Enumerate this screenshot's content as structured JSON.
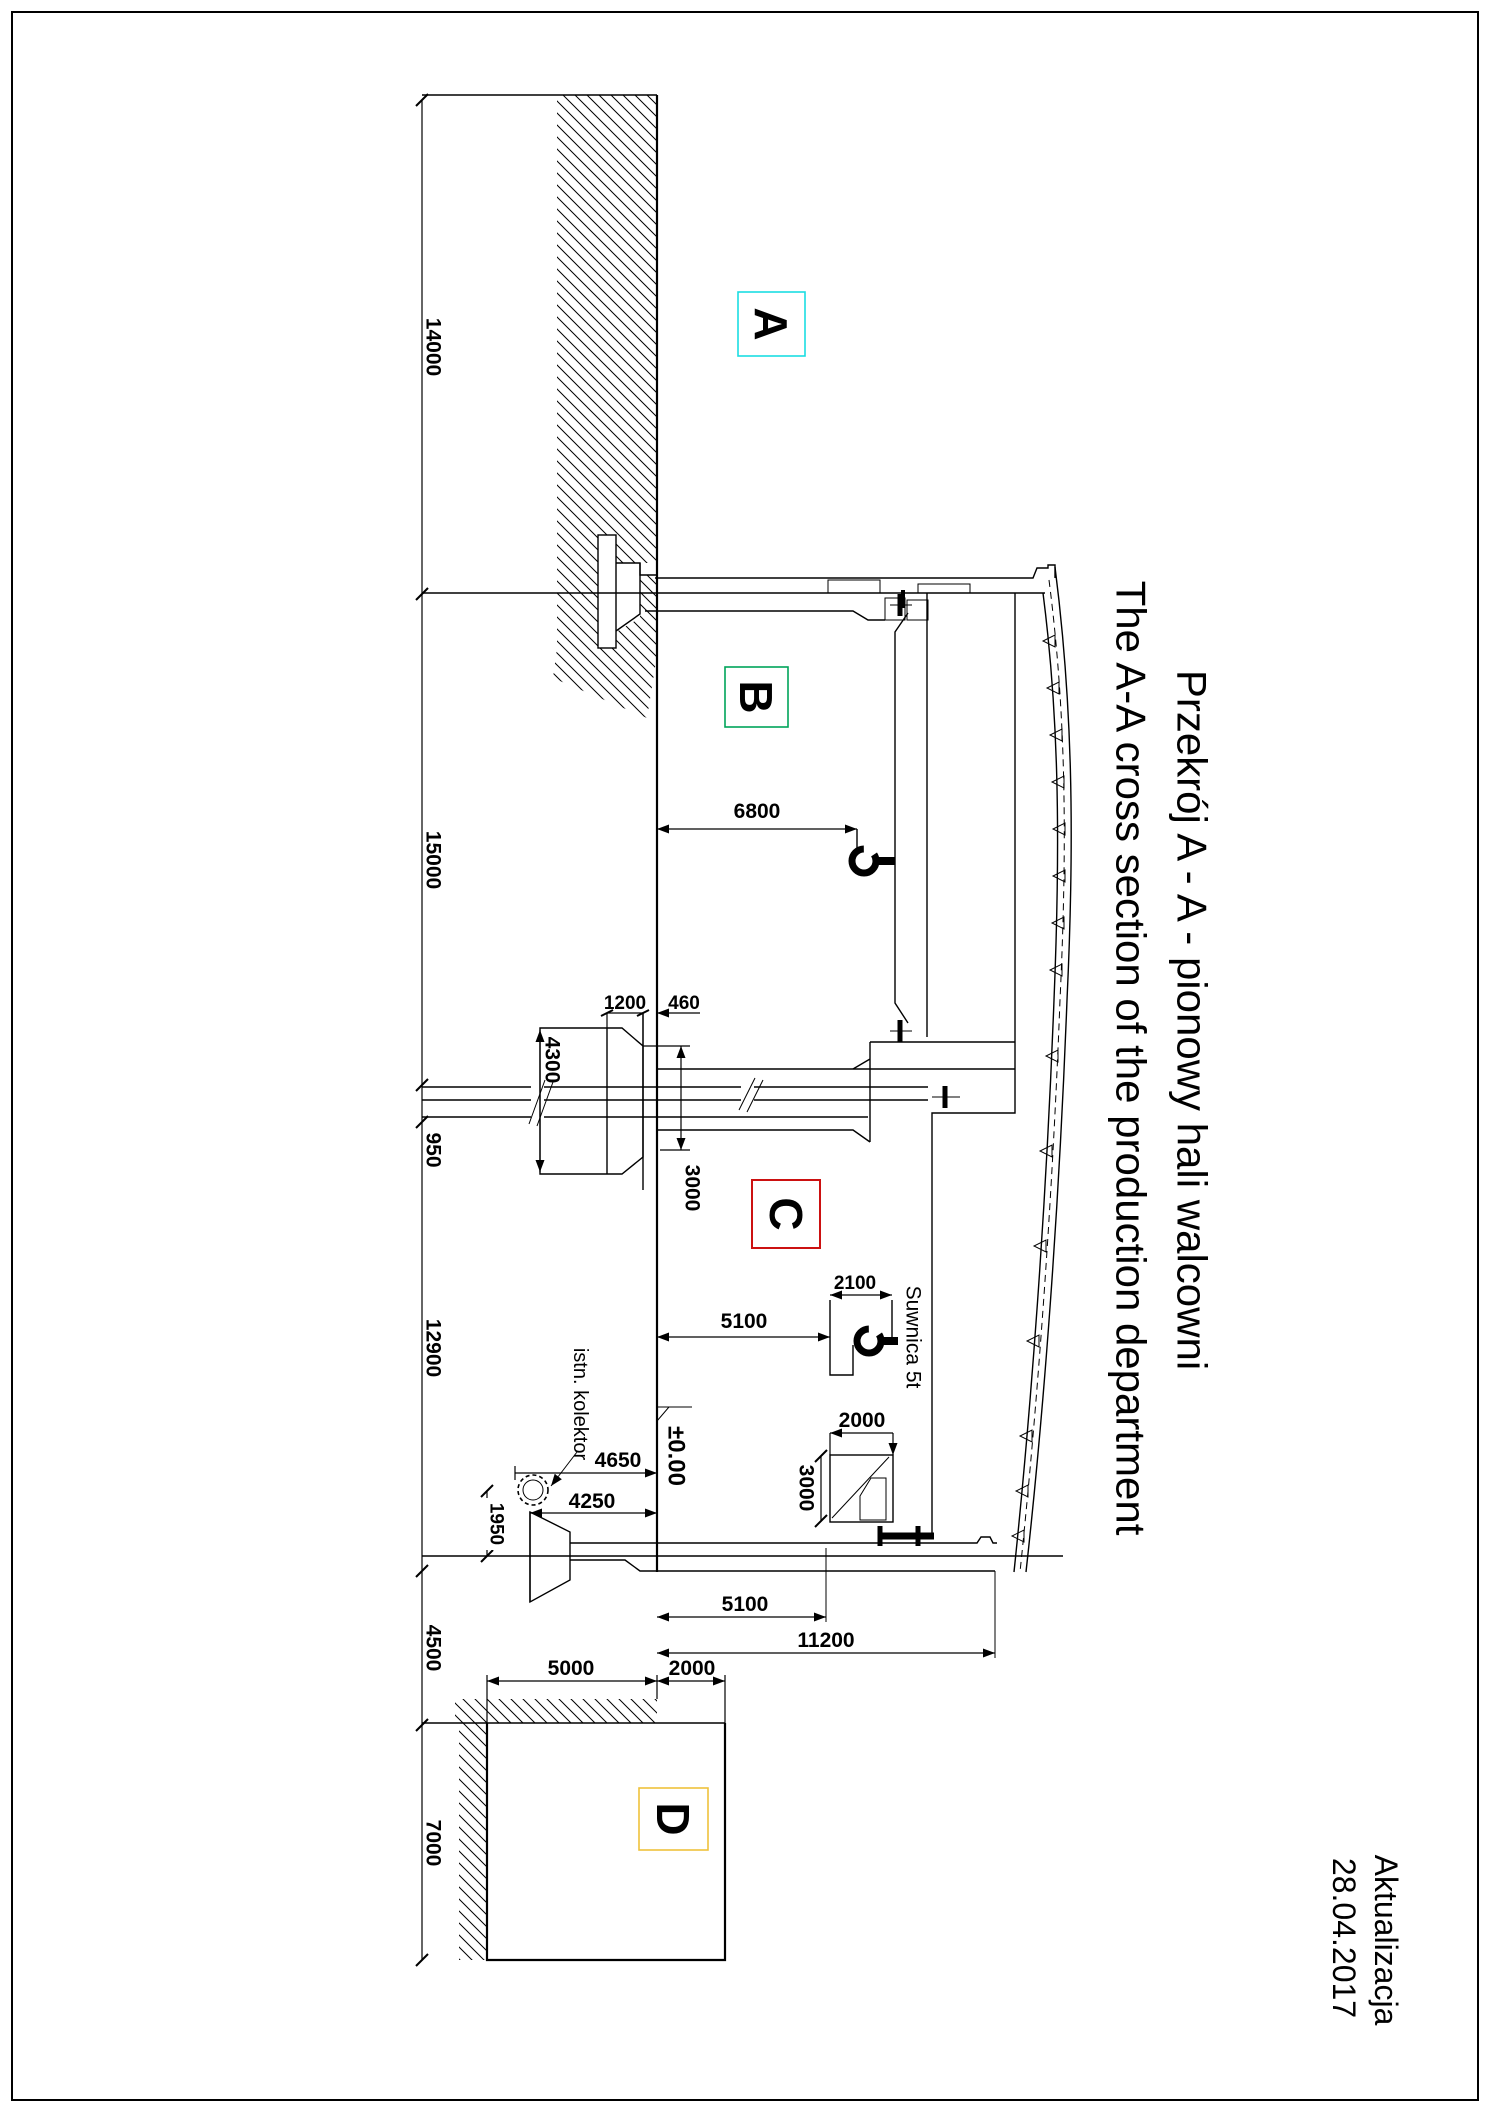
{
  "page": {
    "titles": {
      "pl": "Przekrój A - A - pionowy hali walcowni",
      "en": "The A-A cross section of the production department"
    },
    "update": {
      "label": "Aktualizacja",
      "date": "28.04.2017"
    },
    "zones": {
      "a": "A",
      "b": "B",
      "c": "C",
      "d": "D"
    },
    "notes": {
      "crane": "Suwnica 5t",
      "collector": "istn. kolektor",
      "level": "±0.00"
    },
    "dims": {
      "d14000": "14000",
      "d15000": "15000",
      "d950": "950",
      "d12900": "12900",
      "d4500": "4500",
      "d7000": "7000",
      "d6800": "6800",
      "d4300": "4300",
      "d1200": "1200",
      "d460": "460",
      "d3000a": "3000",
      "d5100a": "5100",
      "d2100": "2100",
      "d2000a": "2000",
      "d3000b": "3000",
      "d4650": "4650",
      "d4250": "4250",
      "d1950": "1950",
      "d5100b": "5100",
      "d11200": "11200",
      "d5000": "5000",
      "d2000b": "2000"
    }
  },
  "colors": {
    "zone_a": "#1BDDE2",
    "zone_b": "#00A45A",
    "zone_c": "#CC1111",
    "zone_d": "#EEC23C",
    "line": "#000000"
  }
}
